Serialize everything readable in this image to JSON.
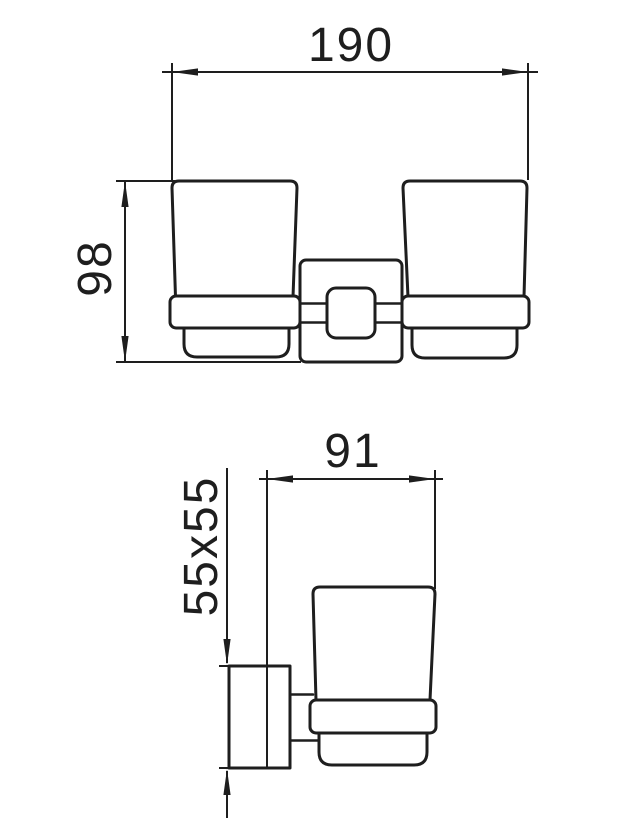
{
  "diagram": {
    "type": "technical-dimension-drawing",
    "subject": "wall-mounted double tumbler holder, front and side views",
    "colors": {
      "line": "#1e1e1e",
      "background": "#ffffff"
    },
    "front_view": {
      "width_label": "190",
      "height_label": "98"
    },
    "side_view": {
      "depth_label": "91",
      "plate_label": "55x55"
    }
  }
}
